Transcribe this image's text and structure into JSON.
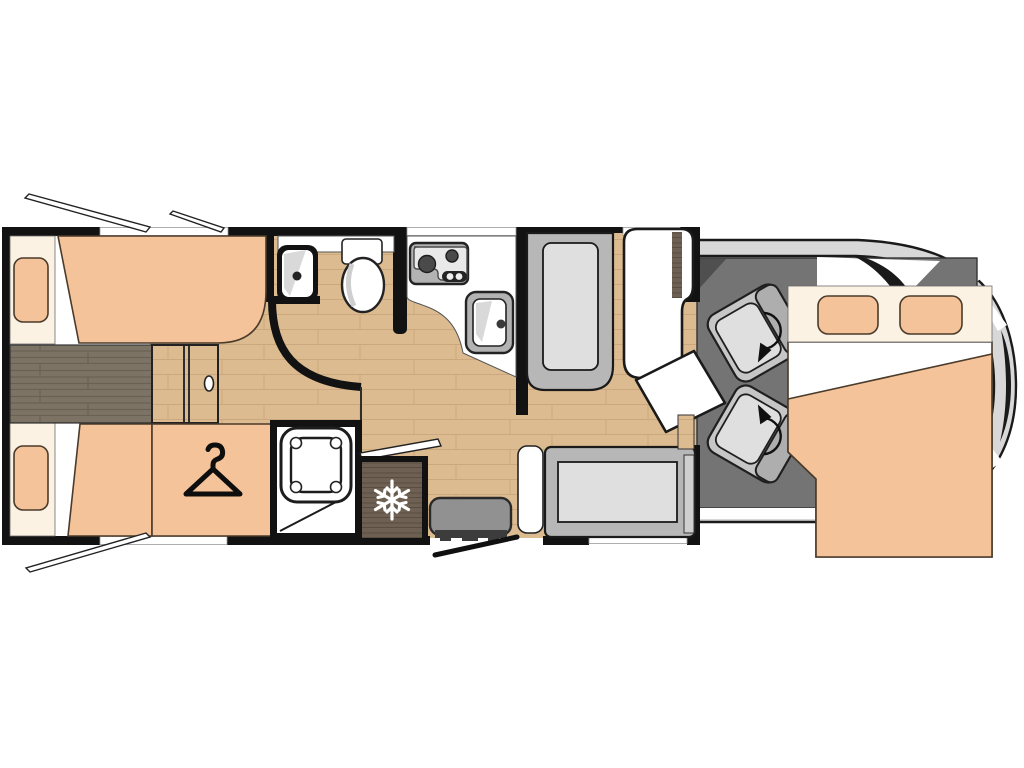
{
  "title": "Motorhome floor plan, top view",
  "colors": {
    "wall": "#121212",
    "white": "#ffffff",
    "cream": "#fbf2e3",
    "mattress": "#f5c39a",
    "mattressEdge": "#4a3b2a",
    "woodBase": "#dcbb90",
    "woodLine": "#c7a478",
    "woodDarkBase": "#7c7365",
    "woodDarkLine": "#696153",
    "fridgeBase": "#6e6153",
    "fridgeLine": "#584d41",
    "cabFloor": "#747474",
    "body": "#d8d8d8",
    "benchOuter": "#b7b7b7",
    "cushion": "#dfdfdf",
    "seatBase": "#c6c6c6",
    "seatBack": "#aeaeae",
    "appliance": "#b3b3b3",
    "applianceFace": "#e9e9e9",
    "burner": "#4a4a4a",
    "step": "#919191",
    "stepDark": "#3c3c3c",
    "shade": "#d9d9d9",
    "dark": "#1a1a1a"
  },
  "plan": {
    "vehicle_type": "motorhome",
    "rooms": [
      {
        "name": "rear-bedroom",
        "furniture": [
          "single-bed-top",
          "single-bed-bottom",
          "center-walkway",
          "bed-step",
          "wardrobe"
        ]
      },
      {
        "name": "washroom",
        "furniture": [
          "corner-washbasin",
          "toilet",
          "vanity-counter"
        ]
      },
      {
        "name": "shower-room",
        "furniture": [
          "shower-tray"
        ]
      },
      {
        "name": "kitchen",
        "furniture": [
          "two-burner-hob",
          "kitchen-sink",
          "worktop",
          "worktop-flap",
          "refrigerator"
        ]
      },
      {
        "name": "dinette",
        "furniture": [
          "forward-bench",
          "table",
          "swivel-table-leaf",
          "side-sofa",
          "sofa-armrest"
        ]
      },
      {
        "name": "entry",
        "furniture": [
          "entry-step",
          "entry-door"
        ]
      },
      {
        "name": "cab",
        "furniture": [
          "driver-swivel-seat",
          "passenger-swivel-seat",
          "drop-down-bed"
        ]
      }
    ],
    "icons": [
      "snowflake-icon",
      "hanger-icon",
      "rotate-arrow-icon"
    ],
    "windows_open_flaps": 3,
    "pillows": 4
  }
}
